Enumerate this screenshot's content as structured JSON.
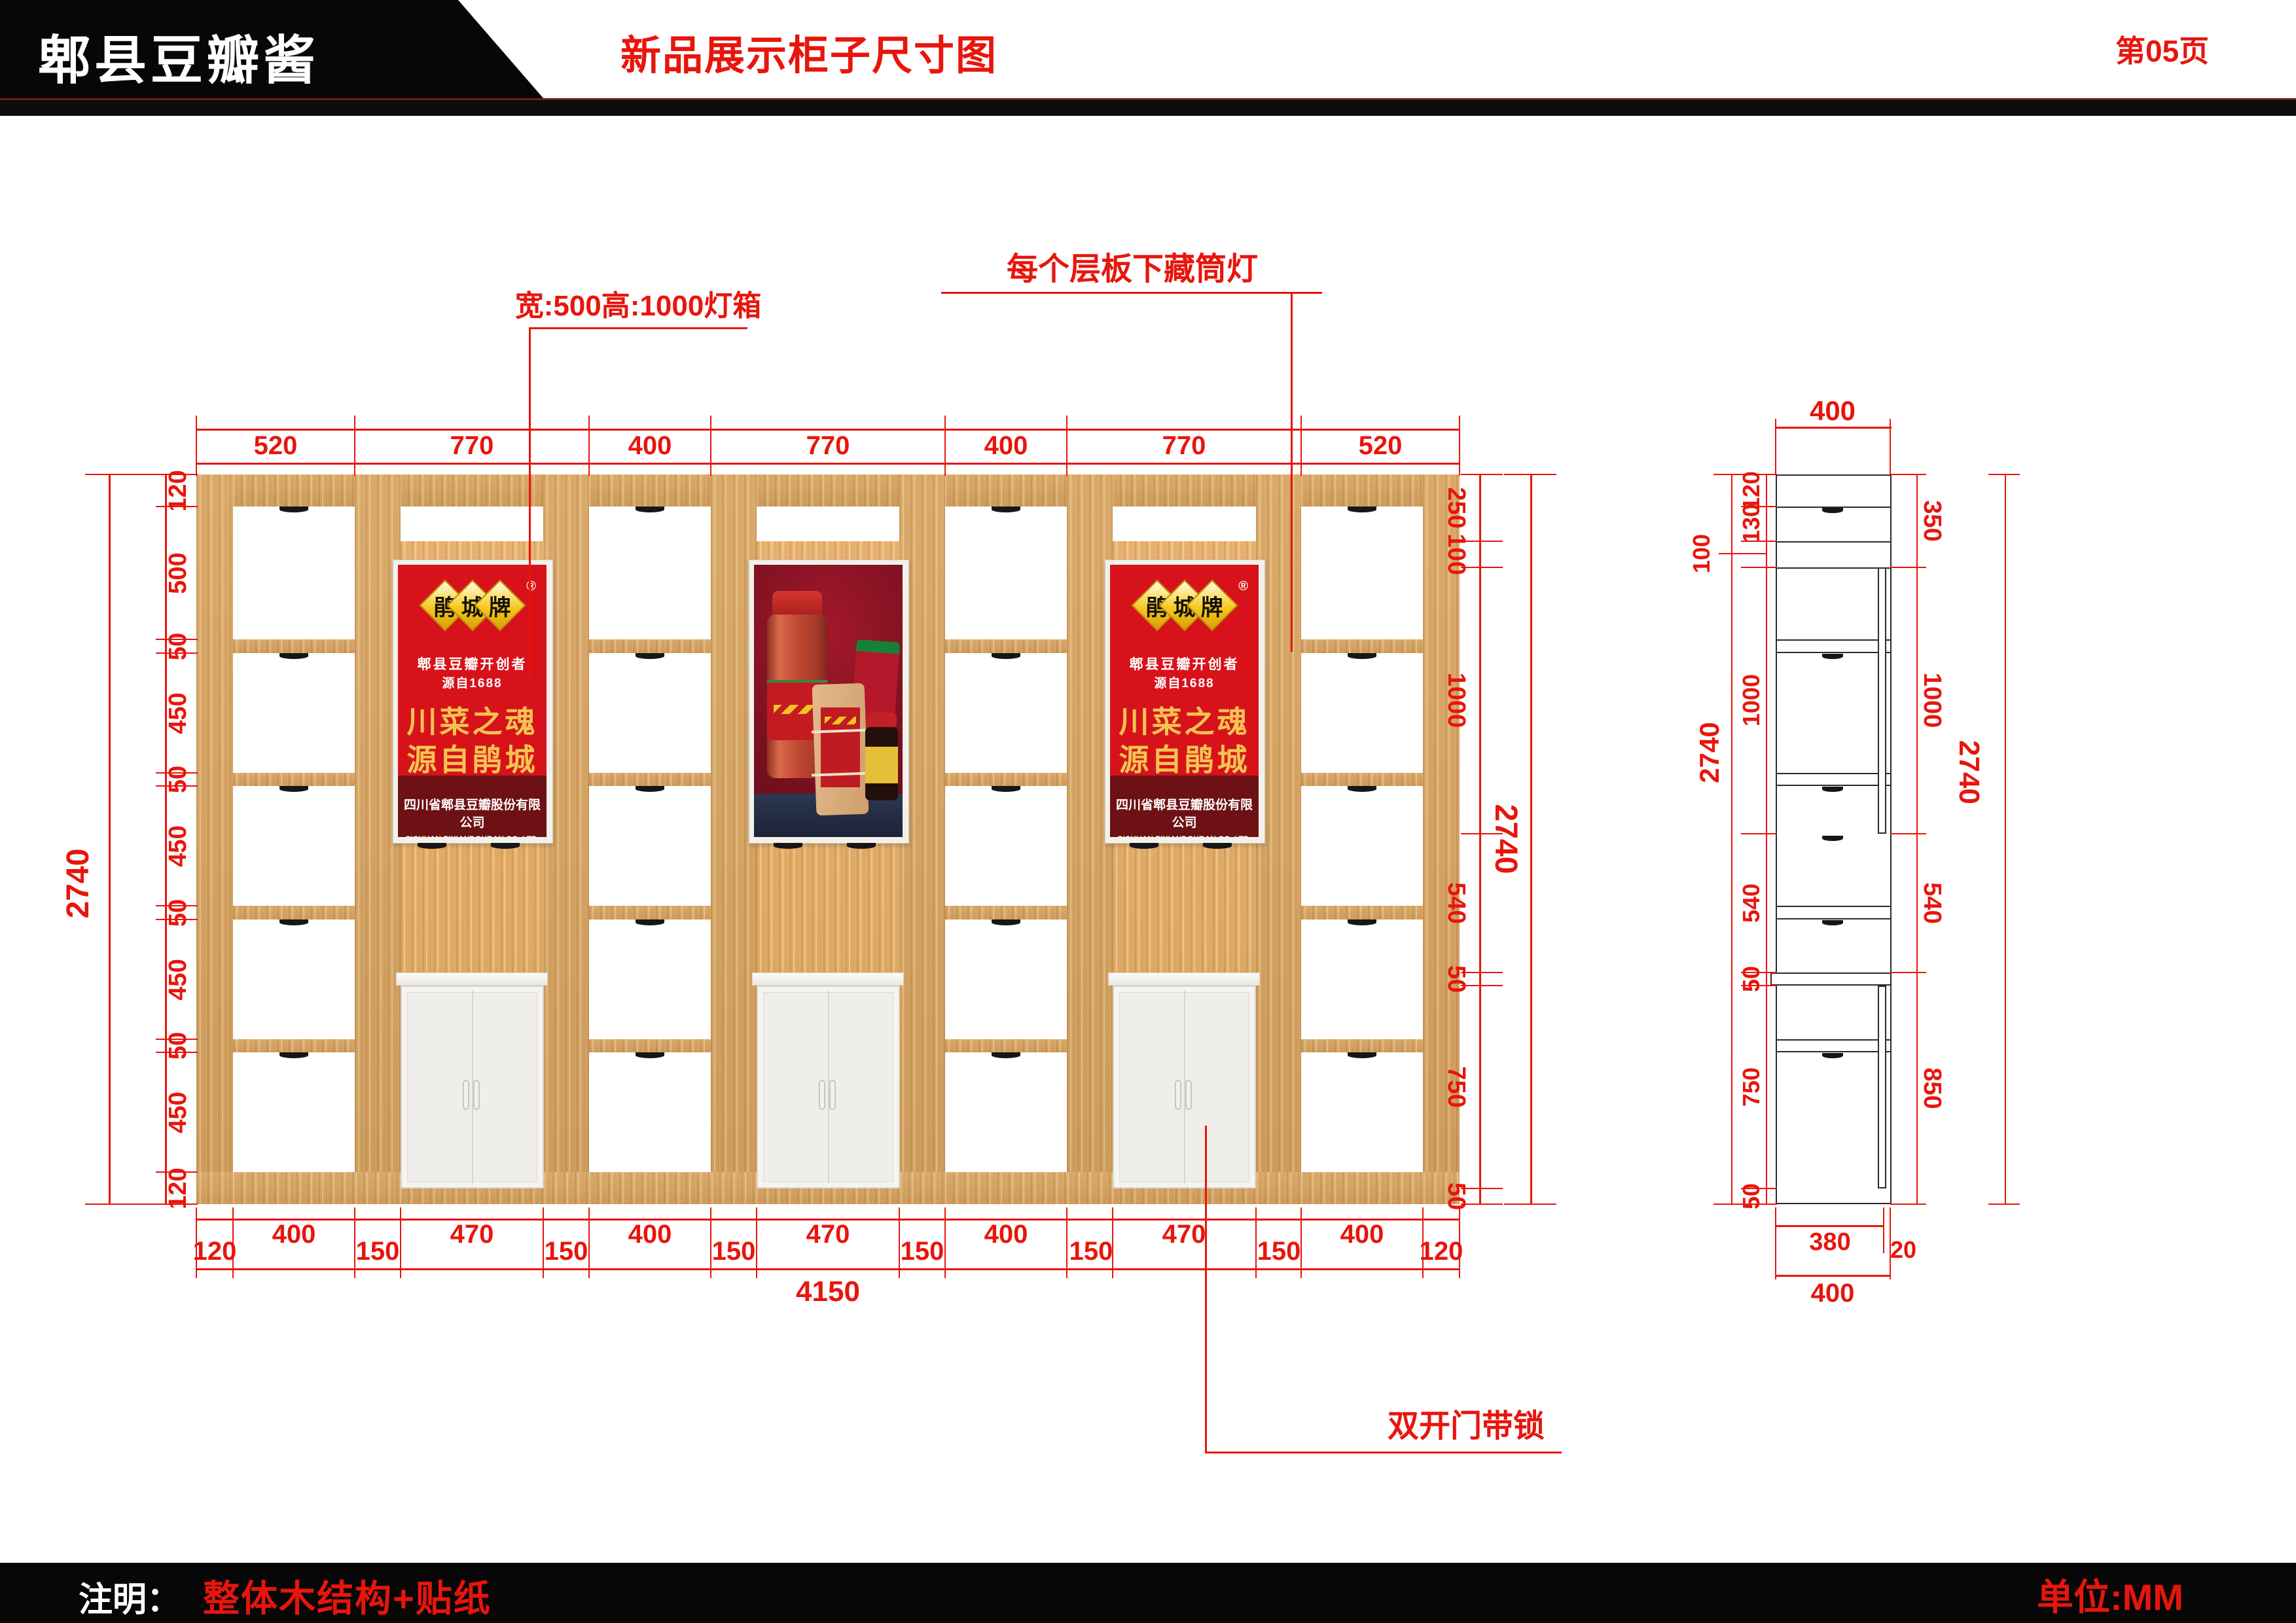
{
  "header": {
    "logo": "郫县豆瓣酱",
    "title": "新品展示柜子尺寸图",
    "page": "第05页"
  },
  "footer": {
    "note_label": "注明：",
    "note_value": "整体木结构+贴纸",
    "unit": "单位:MM"
  },
  "annotations": {
    "lightbox_label": "宽:500高:1000灯箱",
    "downlight_label": "每个层板下藏筒灯",
    "door_label": "双开门带锁"
  },
  "front_view": {
    "top_dims": [
      "520",
      "770",
      "400",
      "770",
      "400",
      "770",
      "520"
    ],
    "left_dims": [
      "120",
      "500",
      "50",
      "450",
      "50",
      "450",
      "50",
      "450",
      "50",
      "450",
      "120"
    ],
    "left_overall": "2740",
    "right_dims": [
      "250",
      "100",
      "1000",
      "540",
      "50",
      "750",
      "50"
    ],
    "right_overall": "2740",
    "bottom_dims": [
      "120",
      "400",
      "150",
      "470",
      "150",
      "400",
      "150",
      "470",
      "150",
      "400",
      "150",
      "470",
      "150",
      "400",
      "120"
    ],
    "bottom_overall": "4150"
  },
  "side_view": {
    "top_dim": "400",
    "left_dims": [
      "120",
      "130",
      "100",
      "1000",
      "540",
      "50",
      "750",
      "50"
    ],
    "left_overall": "2740",
    "right_dims": [
      "350",
      "1000",
      "540",
      "850"
    ],
    "right_overall": "2740",
    "bottom_dims": [
      "380",
      "20"
    ],
    "bottom_overall": "400"
  },
  "poster": {
    "brand_char_1": "鹃",
    "brand_char_2": "城",
    "brand_char_3": "牌",
    "registered": "®",
    "subtitle1": "郫县豆瓣开创者",
    "subtitle2": "源自1688",
    "slogan_line1": "川菜之魂",
    "slogan_line2": "源自鹃城",
    "company_cn": "四川省郫县豆瓣股份有限公司",
    "company_en": "SICHUAN PIXIANDOUBAN CO.,LTD."
  },
  "colors": {
    "dim_red": "#e8150c",
    "wood": "#d9a561",
    "poster_red": "#d8121b",
    "poster_gold": "#f3c452",
    "maroon_band": "#6d1115"
  }
}
